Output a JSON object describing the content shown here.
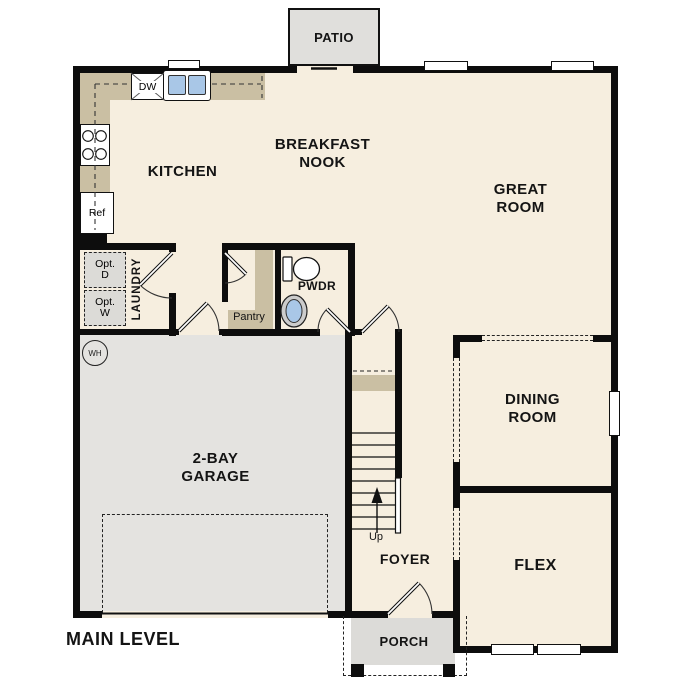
{
  "title": "MAIN LEVEL",
  "rooms": {
    "patio": {
      "label": "PATIO"
    },
    "kitchen": {
      "label": "KITCHEN"
    },
    "breakfast_nook": {
      "label": "BREAKFAST\nNOOK"
    },
    "great_room": {
      "label": "GREAT\nROOM"
    },
    "dining_room": {
      "label": "DINING\nROOM"
    },
    "flex": {
      "label": "FLEX"
    },
    "foyer": {
      "label": "FOYER"
    },
    "garage": {
      "label": "2-BAY\nGARAGE"
    },
    "laundry": {
      "label": "LAUNDRY"
    },
    "pantry": {
      "label": "Pantry"
    },
    "powder": {
      "label": "PWDR"
    },
    "porch": {
      "label": "PORCH"
    }
  },
  "fixtures": {
    "dishwasher": "DW",
    "refrigerator": "Ref",
    "water_heater": "WH",
    "optional_dryer": "Opt.\nD",
    "optional_washer": "Opt.\nW",
    "stairs_direction": "Up"
  },
  "colors": {
    "floor": "#f6eedf",
    "counter": "#cabfa3",
    "garage": "#e4e3e0",
    "patio": "#e0dfdc",
    "basin": "#a9c7e7",
    "wall": "#0d0d0d"
  }
}
